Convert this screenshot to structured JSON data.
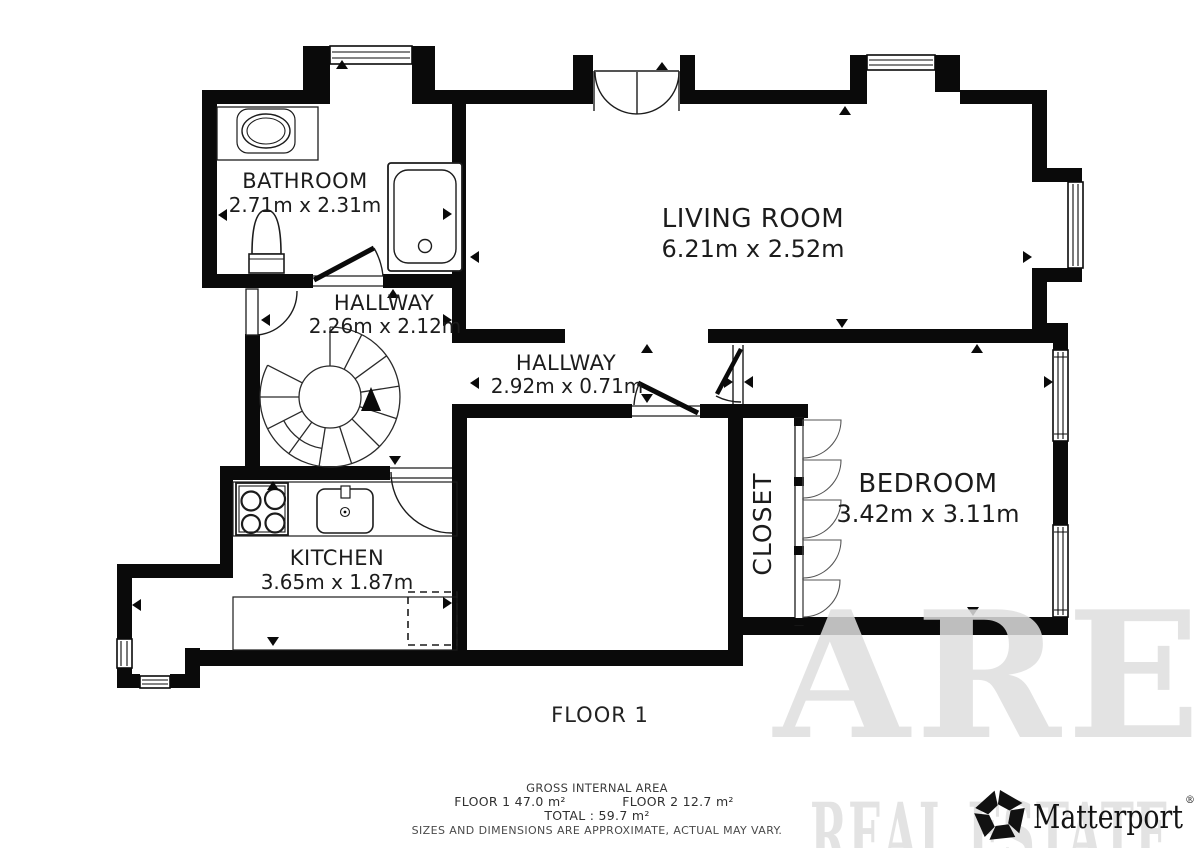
{
  "rooms": {
    "bathroom": {
      "name": "BATHROOM",
      "dims": "2.71m x 2.31m"
    },
    "living_room": {
      "name": "LIVING ROOM",
      "dims": "6.21m x 2.52m"
    },
    "hallway_upper": {
      "name": "HALLWAY",
      "dims": "2.26m x 2.12m"
    },
    "hallway_lower": {
      "name": "HALLWAY",
      "dims": "2.92m x 0.71m"
    },
    "bedroom": {
      "name": "BEDROOM",
      "dims": "3.42m x 3.11m"
    },
    "closet": {
      "name": "CLOSET"
    },
    "kitchen": {
      "name": "KITCHEN",
      "dims": "3.65m x 1.87m"
    }
  },
  "floor_label": "FLOOR 1",
  "footer": {
    "title": "GROSS INTERNAL AREA",
    "floor1_area": "FLOOR 1 47.0 m²",
    "floor2_area": "FLOOR 2 12.7 m²",
    "total": "TOTAL :  59.7 m²",
    "disclaimer": "SIZES AND DIMENSIONS ARE APPROXIMATE, ACTUAL MAY VARY."
  },
  "watermark": {
    "line1": "ARE",
    "line2": "REAL ESTATE"
  },
  "branding": {
    "logo_text": "Matterport",
    "registered_mark": "®"
  },
  "colors": {
    "walls": "#0a0a0a",
    "background": "#ffffff",
    "fixtures": "#1c1c1c",
    "watermark": "#dedede",
    "footer_text": "#3c3c3c"
  }
}
